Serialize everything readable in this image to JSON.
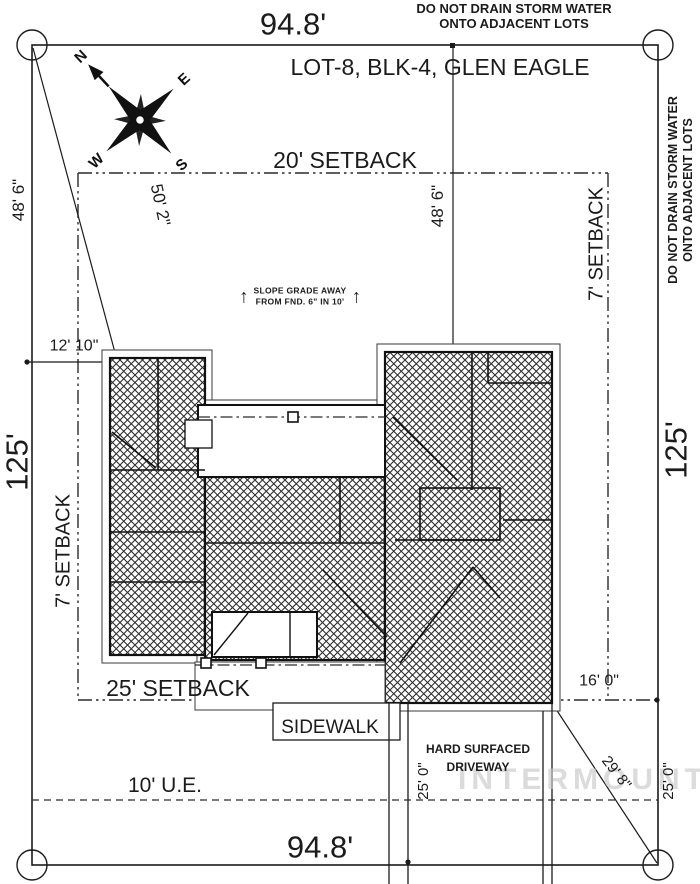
{
  "drawing": {
    "title": "LOT-8, BLK-4, GLEN EAGLE",
    "top_note": {
      "line1": "DO NOT DRAIN STORM WATER",
      "line2": "ONTO ADJACENT LOTS"
    },
    "side_note": {
      "line1": "DO NOT DRAIN STORM WATER",
      "line2": "ONTO ADJACENT LOTS"
    },
    "dimensions": {
      "lot_width_top": "94.8'",
      "lot_width_bottom": "94.8'",
      "lot_depth_left": "125'",
      "lot_depth_right": "125'",
      "front_setback": "20' SETBACK",
      "rear_setback": "25' SETBACK",
      "side_setback_left": "7' SETBACK",
      "side_setback_right": "7' SETBACK",
      "left_48_6": "48' 6\"",
      "mid_48_6": "48' 6\"",
      "diag_50_2": "50' 2\"",
      "left_12_10": "12' 10\"",
      "right_16_0": "16' 0\"",
      "driveway_25_0_left": "25' 0\"",
      "driveway_25_0_right": "25' 0\"",
      "diag_29_8": "29' 8\"",
      "utility_easement": "10' U.E."
    },
    "slope_note": {
      "line1": "SLOPE GRADE AWAY",
      "line2": "FROM FND. 6\" IN 10'",
      "arrow": "↑"
    },
    "labels": {
      "sidewalk": "SIDEWALK",
      "driveway_line1": "HARD SURFACED",
      "driveway_line2": "DRIVEWAY"
    },
    "compass": {
      "n": "N",
      "e": "E",
      "s": "S",
      "w": "W"
    },
    "watermark": "INTERMOUNTAIN",
    "colors": {
      "line": "#1b1b1b",
      "roofline": "#4a4a4a",
      "watermark": "#c9c9c9",
      "paper": "#ffffff"
    }
  }
}
